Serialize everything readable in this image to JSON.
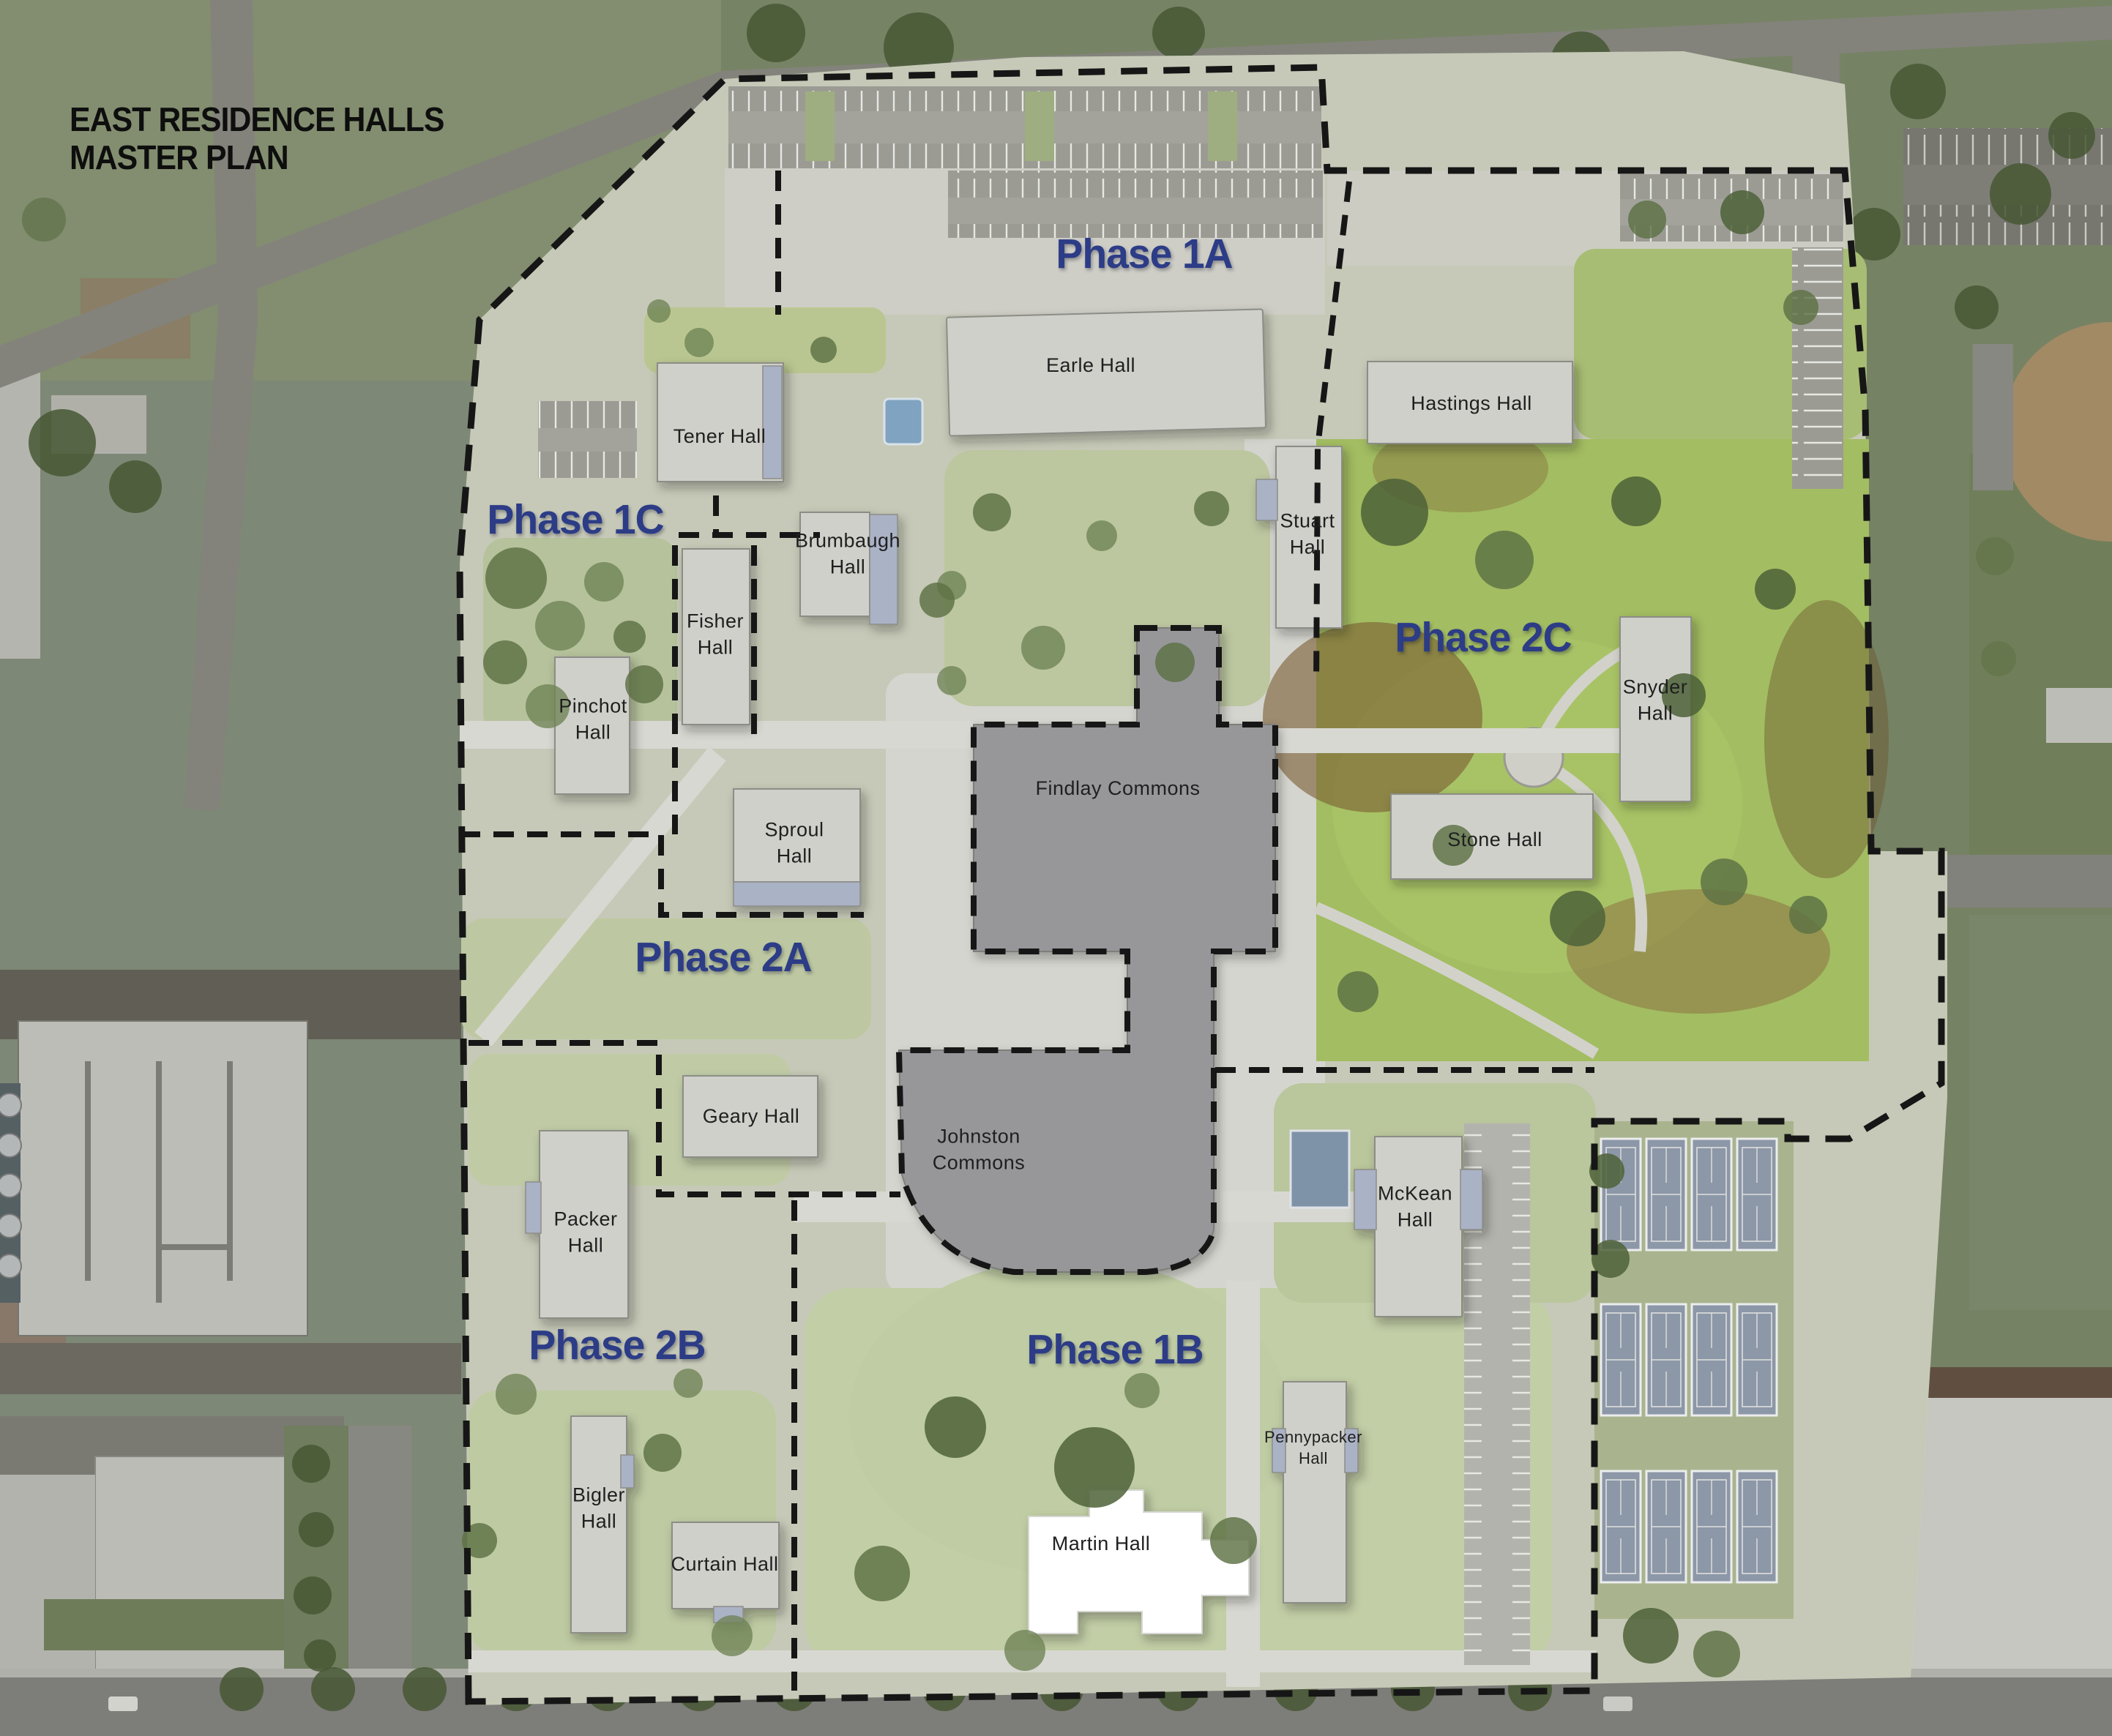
{
  "title": {
    "line1": "EAST RESIDENCE HALLS",
    "line2": "MASTER PLAN"
  },
  "phase_labels": [
    {
      "id": "phase-1a",
      "label": "Phase 1A"
    },
    {
      "id": "phase-1c",
      "label": "Phase 1C"
    },
    {
      "id": "phase-2c",
      "label": "Phase 2C"
    },
    {
      "id": "phase-2a",
      "label": "Phase 2A"
    },
    {
      "id": "phase-2b",
      "label": "Phase 2B"
    },
    {
      "id": "phase-1b",
      "label": "Phase 1B"
    }
  ],
  "building_labels": [
    {
      "id": "earle",
      "label": "Earle Hall"
    },
    {
      "id": "tener",
      "label": "Tener Hall"
    },
    {
      "id": "hastings",
      "label": "Hastings Hall"
    },
    {
      "id": "stuart",
      "label": "Stuart\nHall"
    },
    {
      "id": "brumbaugh",
      "label": "Brumbaugh\nHall"
    },
    {
      "id": "fisher",
      "label": "Fisher\nHall"
    },
    {
      "id": "pinchot",
      "label": "Pinchot\nHall"
    },
    {
      "id": "snyder",
      "label": "Snyder\nHall"
    },
    {
      "id": "sproul",
      "label": "Sproul\nHall"
    },
    {
      "id": "findlay",
      "label": "Findlay Commons"
    },
    {
      "id": "stone",
      "label": "Stone Hall"
    },
    {
      "id": "geary",
      "label": "Geary Hall"
    },
    {
      "id": "johnston",
      "label": "Johnston\nCommons"
    },
    {
      "id": "packer",
      "label": "Packer\nHall"
    },
    {
      "id": "mckean",
      "label": "McKean\nHall"
    },
    {
      "id": "bigler",
      "label": "Bigler\nHall"
    },
    {
      "id": "pennypacker",
      "label": "Pennypacker\nHall"
    },
    {
      "id": "curtain",
      "label": "Curtain Hall"
    },
    {
      "id": "martin",
      "label": "Martin Hall"
    }
  ],
  "map_colors": {
    "phase_label_text": "#2c3c86",
    "title_text": "#0e0e0e",
    "building_label_text": "#1f1f1f",
    "boundary_dash": "#161616",
    "building_fill": "#d0d0cb",
    "commons_fill": "#97979a",
    "bright_lawn_green": "#a3bd62",
    "tennis_court_blue": "#8c97a8",
    "martin_hall_fill": "#ffffff"
  }
}
